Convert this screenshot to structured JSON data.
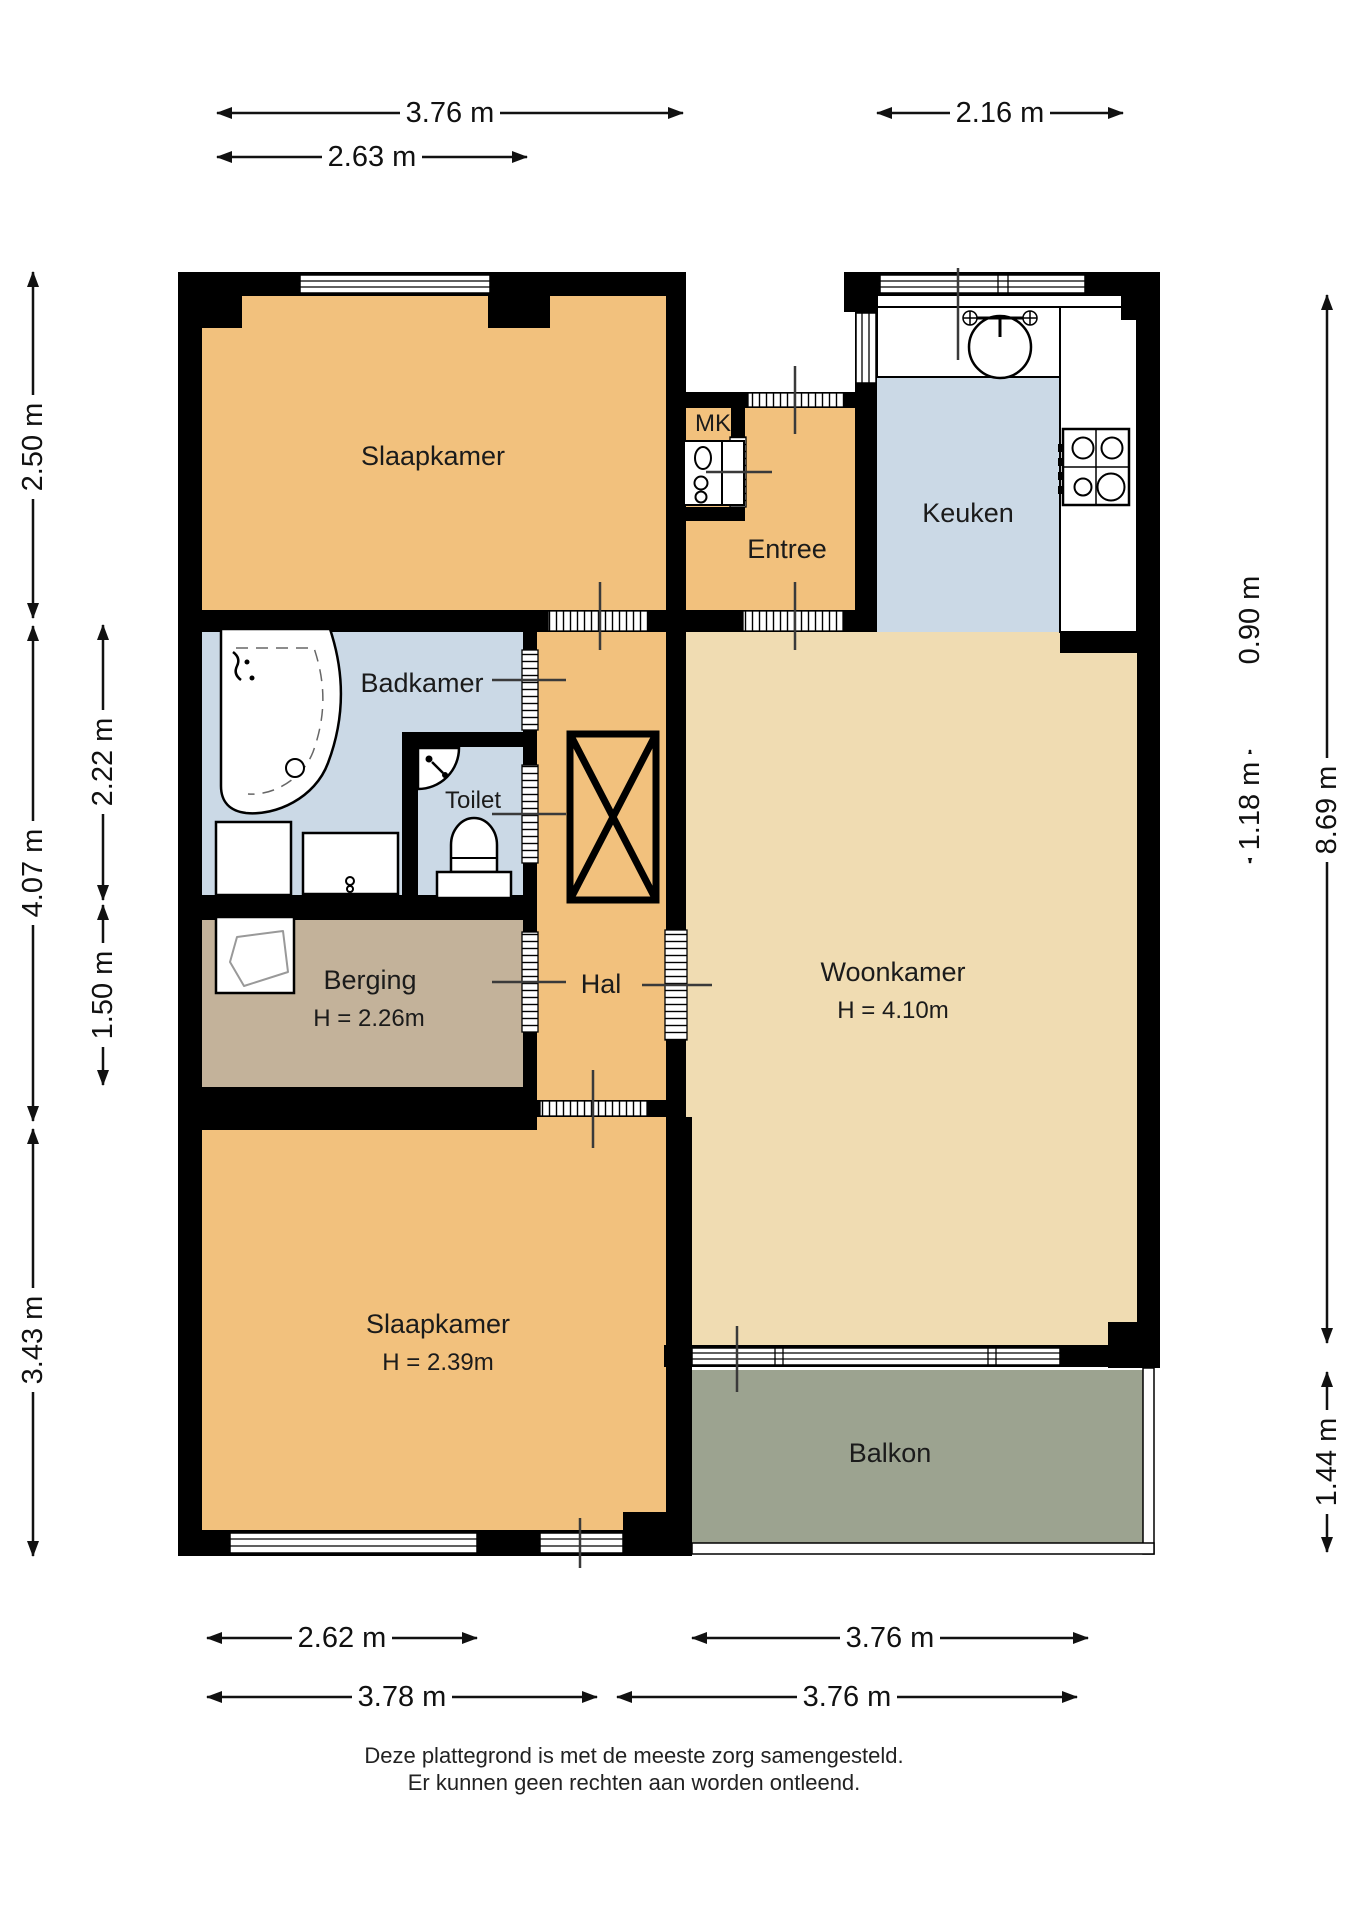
{
  "plan": {
    "rooms": {
      "slaapkamer_top": {
        "label": "Slaapkamer"
      },
      "keuken": {
        "label": "Keuken"
      },
      "mk": {
        "label": "MK"
      },
      "entree": {
        "label": "Entree"
      },
      "badkamer": {
        "label": "Badkamer"
      },
      "toilet": {
        "label": "Toilet"
      },
      "berging": {
        "label": "Berging",
        "height": "H = 2.26m"
      },
      "hal": {
        "label": "Hal"
      },
      "woonkamer": {
        "label": "Woonkamer",
        "height": "H = 4.10m"
      },
      "slaapkamer_bottom": {
        "label": "Slaapkamer",
        "height": "H = 2.39m"
      },
      "balkon": {
        "label": "Balkon"
      }
    },
    "dimensions": {
      "top": [
        {
          "label": "3.76 m"
        },
        {
          "label": "2.16 m"
        },
        {
          "label": "2.63 m"
        }
      ],
      "left": [
        {
          "label": "2.50 m"
        },
        {
          "label": "4.07 m"
        },
        {
          "label": "3.43 m"
        },
        {
          "label": "2.22 m"
        },
        {
          "label": "1.50 m"
        }
      ],
      "right": [
        {
          "label": "0.90 m"
        },
        {
          "label": "1.18 m"
        },
        {
          "label": "8.69 m"
        },
        {
          "label": "1.44 m"
        }
      ],
      "bottom": [
        {
          "label": "2.62 m"
        },
        {
          "label": "3.76 m"
        },
        {
          "label": "3.78 m"
        },
        {
          "label": "3.76 m"
        }
      ]
    },
    "disclaimer": [
      "Deze plattegrond is met de meeste zorg samengesteld.",
      "Er kunnen geen rechten aan worden ontleend."
    ],
    "colors": {
      "room_orange": "#f2c17d",
      "room_beige": "#f0dcb2",
      "room_blue": "#cbd9e6",
      "room_tan": "#c3b29a",
      "room_balcony": "#9ca390",
      "wall": "#000000"
    }
  }
}
